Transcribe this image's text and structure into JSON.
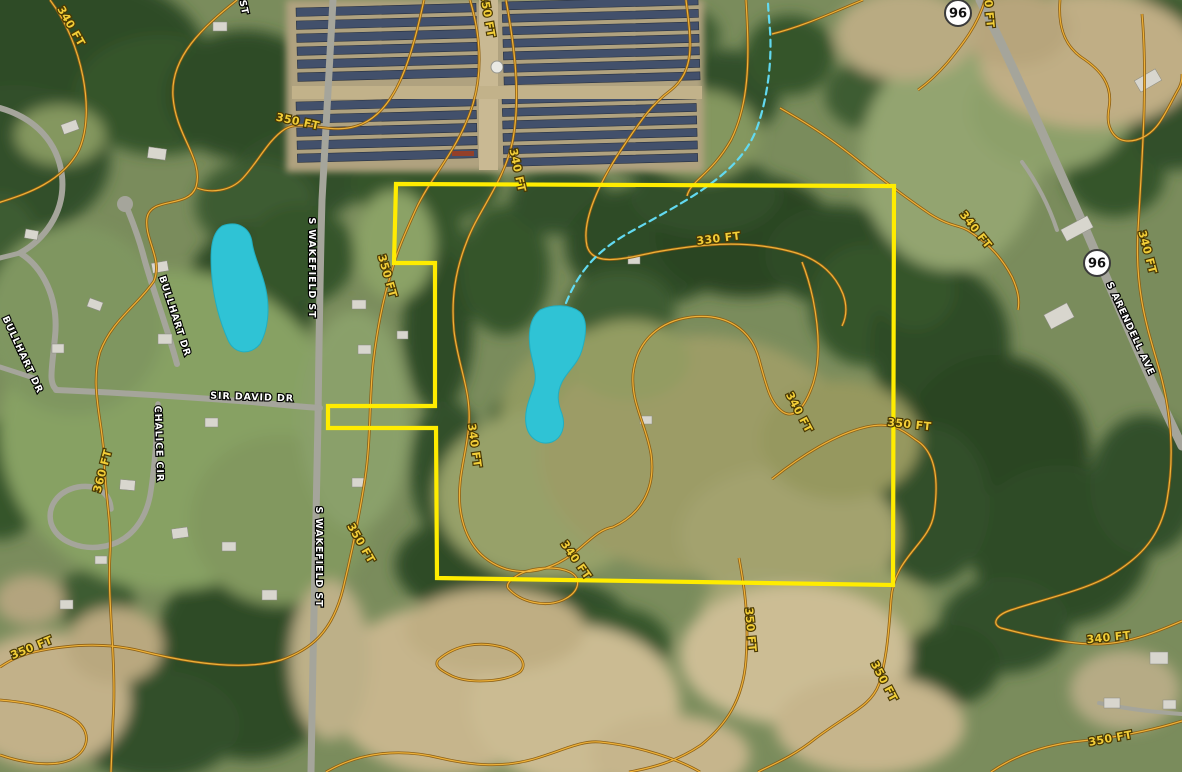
{
  "map": {
    "title": "Aerial parcel map with elevation contours",
    "colors": {
      "parcel_boundary": "#ffec00",
      "contour_casing": "#8a5c10",
      "contour_core": "#eeb23a",
      "contour_label_fill": "#f2ce38",
      "contour_label_outline": "#4a3903",
      "street_label_fill": "#ffffff",
      "street_label_outline": "#000000",
      "pond_fill": "#2fc3d5",
      "pond_edge": "#21aec1",
      "stream": "#62d9f0",
      "shield_fill": "#ffffff",
      "shield_border": "#3a3a3a",
      "shield_text": "#111111"
    },
    "contour_labels": [
      {
        "text": "340 FT",
        "x": 68,
        "y": 28,
        "rot": 60
      },
      {
        "text": "350 FT",
        "x": 297,
        "y": 125,
        "rot": 12
      },
      {
        "text": "350 FT",
        "x": 484,
        "y": 16,
        "rot": 80
      },
      {
        "text": "340 FT",
        "x": 514,
        "y": 171,
        "rot": 78
      },
      {
        "text": "330 FT",
        "x": 719,
        "y": 242,
        "rot": -7
      },
      {
        "text": "350 FT",
        "x": 384,
        "y": 277,
        "rot": 74
      },
      {
        "text": "340 FT",
        "x": 471,
        "y": 446,
        "rot": 82
      },
      {
        "text": "340 FT",
        "x": 796,
        "y": 414,
        "rot": 62
      },
      {
        "text": "350 FT",
        "x": 909,
        "y": 428,
        "rot": 6
      },
      {
        "text": "340 FT",
        "x": 1144,
        "y": 253,
        "rot": 75
      },
      {
        "text": "340 FT",
        "x": 973,
        "y": 232,
        "rot": 52
      },
      {
        "text": "360 FT",
        "x": 106,
        "y": 472,
        "rot": -75
      },
      {
        "text": "350 FT",
        "x": 358,
        "y": 545,
        "rot": 60
      },
      {
        "text": "350 FT",
        "x": 33,
        "y": 651,
        "rot": -22
      },
      {
        "text": "340 FT",
        "x": 573,
        "y": 562,
        "rot": 55
      },
      {
        "text": "350 FT",
        "x": 747,
        "y": 630,
        "rot": 85
      },
      {
        "text": "340 FT",
        "x": 1109,
        "y": 641,
        "rot": -6
      },
      {
        "text": "350 FT",
        "x": 881,
        "y": 683,
        "rot": 62
      },
      {
        "text": "350 FT",
        "x": 1111,
        "y": 742,
        "rot": -10
      },
      {
        "text": "340 FT",
        "x": 985,
        "y": 6,
        "rot": 85
      }
    ],
    "street_labels": [
      {
        "text": "ST",
        "x": 241,
        "y": 8,
        "rot": 78
      },
      {
        "text": "S WAKEFIELD ST",
        "x": 309,
        "y": 268,
        "rot": 90
      },
      {
        "text": "S WAKEFIELD ST",
        "x": 316,
        "y": 557,
        "rot": 90
      },
      {
        "text": "BULLHART DR",
        "x": 172,
        "y": 317,
        "rot": 72
      },
      {
        "text": "BULLHART DR",
        "x": 20,
        "y": 356,
        "rot": 65
      },
      {
        "text": "SIR DAVID DR",
        "x": 252,
        "y": 400,
        "rot": 2
      },
      {
        "text": "CHALICE CIR",
        "x": 156,
        "y": 444,
        "rot": 88
      },
      {
        "text": "S ARENDELL AVE",
        "x": 1128,
        "y": 330,
        "rot": 65
      }
    ],
    "route_shields": [
      {
        "label": "96",
        "x": 958,
        "y": 13
      },
      {
        "label": "96",
        "x": 1097,
        "y": 263
      }
    ]
  }
}
